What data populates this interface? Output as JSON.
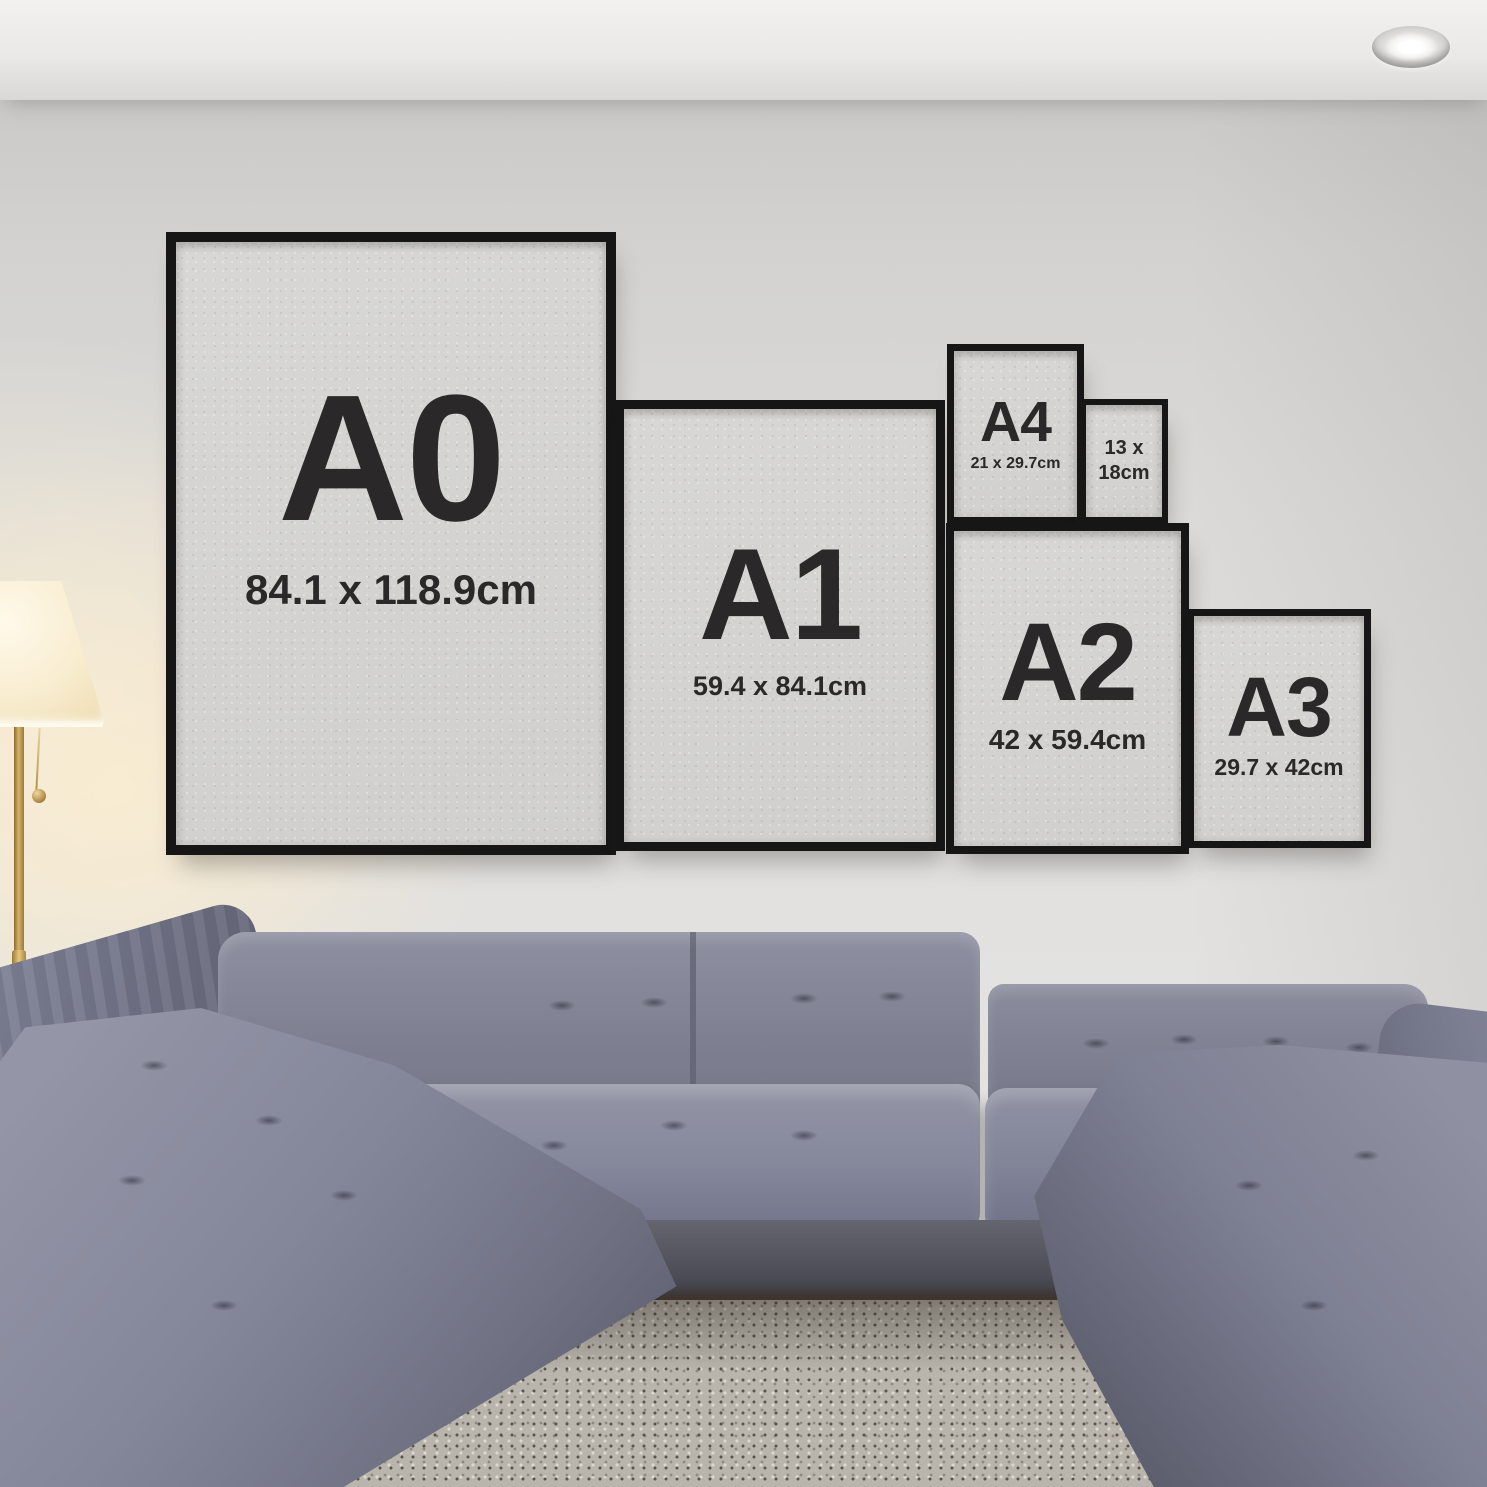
{
  "frames": {
    "a0": {
      "label": "A0",
      "size": "84.1 x 118.9cm"
    },
    "a1": {
      "label": "A1",
      "size": "59.4 x 84.1cm"
    },
    "a2": {
      "label": "A2",
      "size": "42 x 59.4cm"
    },
    "a3": {
      "label": "A3",
      "size": "29.7 x 42cm"
    },
    "a4": {
      "label": "A4",
      "size": "21 x 29.7cm"
    },
    "f13x18": {
      "line1": "13 x",
      "line2": "18cm"
    }
  },
  "colors": {
    "frame_black": "#181818",
    "poster_paper": "#d4d3d1",
    "poster_text": "#2b2829",
    "wall": "#e0dfdd",
    "ceiling": "#f1f0ee",
    "sofa_gray": "#75778a",
    "sofa_shadow": "#3c3d49",
    "rug_gray": "#b9b5ac",
    "lamp_shade_warm": "#f8edd0",
    "lamp_brass": "#b68f4e"
  }
}
